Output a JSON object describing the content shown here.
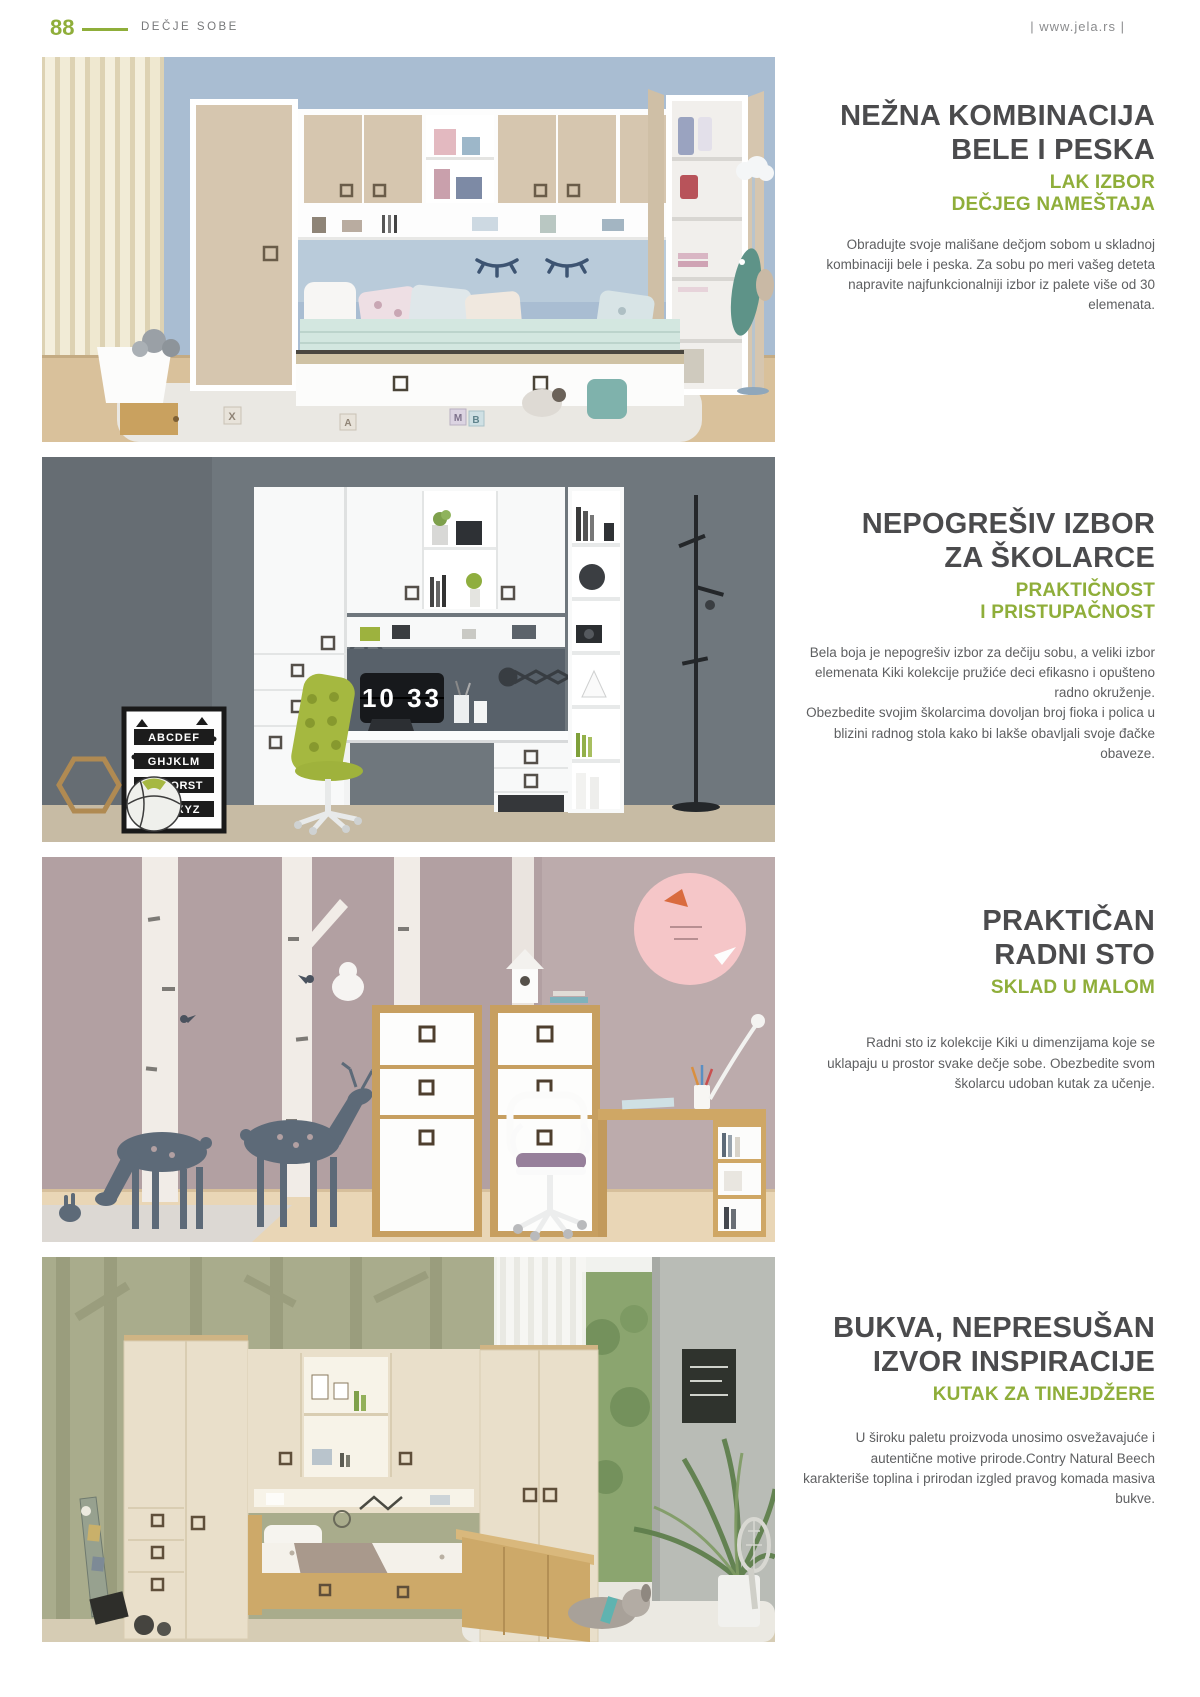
{
  "page": {
    "number": "88",
    "section_label": "DEČJE SOBE",
    "website": "| www.jela.rs |"
  },
  "colors": {
    "accent_green": "#8fae3a",
    "heading_gray": "#4b4b4d",
    "body_gray": "#5e5f61",
    "header_gray": "#77787a"
  },
  "sections": [
    {
      "title1": "NEŽNA KOMBINACIJA",
      "title2": "BELE I PESKA",
      "sub1": "LAK IZBOR",
      "sub2": "DEČJEG NAMEŠTAJA",
      "body1": "Obradujte  svoje mališane dečjom sobom u skladnoj kombinaciji bele i peska. Za sobu po meri vašeg deteta napravite najfunkcionalniji izbor iz palete više od 30 elemenata.",
      "photo": {
        "description": "Dečja soba u beloj i pesak boji: most-ormani iznad kreveta, otvoreni garderober, plišane igračke",
        "wall_color": "#a9bdd2",
        "furniture_color": "#d6c6af",
        "bedding_color": "#d3e7e0",
        "block_letters": [
          "X",
          "A",
          "M",
          "B"
        ]
      }
    },
    {
      "title1": "NEPOGREŠIV IZBOR",
      "title2": "ZA ŠKOLARCE",
      "sub1": "PRAKTIČNOST",
      "sub2": "I PRISTUPAČNOST",
      "body1": "Bela boja je nepogrešiv izbor za dečiju sobu, a veliki izbor elemenata Kiki kolekcije pružiće deci efikasno i opušteno radno okruženje.",
      "body2": "Obezbedite svojim školarcima dovoljan broj fioka i polica u blizini radnog stola kako bi lakše obavljali svoje đačke obaveze.",
      "photo": {
        "description": "Beli Kiki radni zid sa pisaćim stolom, zelenom stolicom i preklopnim satom",
        "wall_color": "#6f777d",
        "furniture_color": "#f8f9f9",
        "chair_color": "#a5b840",
        "clock_time": "10 33",
        "poster_lines": [
          "ABCDEF",
          "GHJKLM",
          "NOPQRST",
          "UVWXYZ"
        ]
      }
    },
    {
      "title1": "PRAKTIČAN",
      "title2": "RADNI STO",
      "sub1": "SKLAD U MALOM",
      "body1": "Radni sto iz kolekcije Kiki u dimenzijama koje se uklapaju u  prostor svake dečje sobe. Obezbedite svom školarcu udoban kutak za učenje.",
      "photo": {
        "description": "Radni sto i dva ormarića Kiki, zid sa brezama i jelenima, roze kružna tabla",
        "wall_color": "#b2a0a2",
        "wood_color": "#c79f60"
      }
    },
    {
      "title1": "BUKVA, NEPRESUŠAN",
      "title2": "IZVOR INSPIRACIJE",
      "sub1": "KUTAK ZA TINEJDŽERE",
      "body1": "U široku paletu proizvoda unosimo osvežavajuće i autentične motive prirode.Contry Natural Beech karakteriše toplina i prirodan izgled pravog komada masiva bukve.",
      "photo": {
        "description": "Contry Natural Beech tinejdžerska soba: garderoberi, most i drveni krevet, zavesa i pogled u zelenilo",
        "wall_color": "#a9ac8c",
        "furniture_color": "#e9dfca",
        "wood_color": "#cda969"
      }
    }
  ]
}
